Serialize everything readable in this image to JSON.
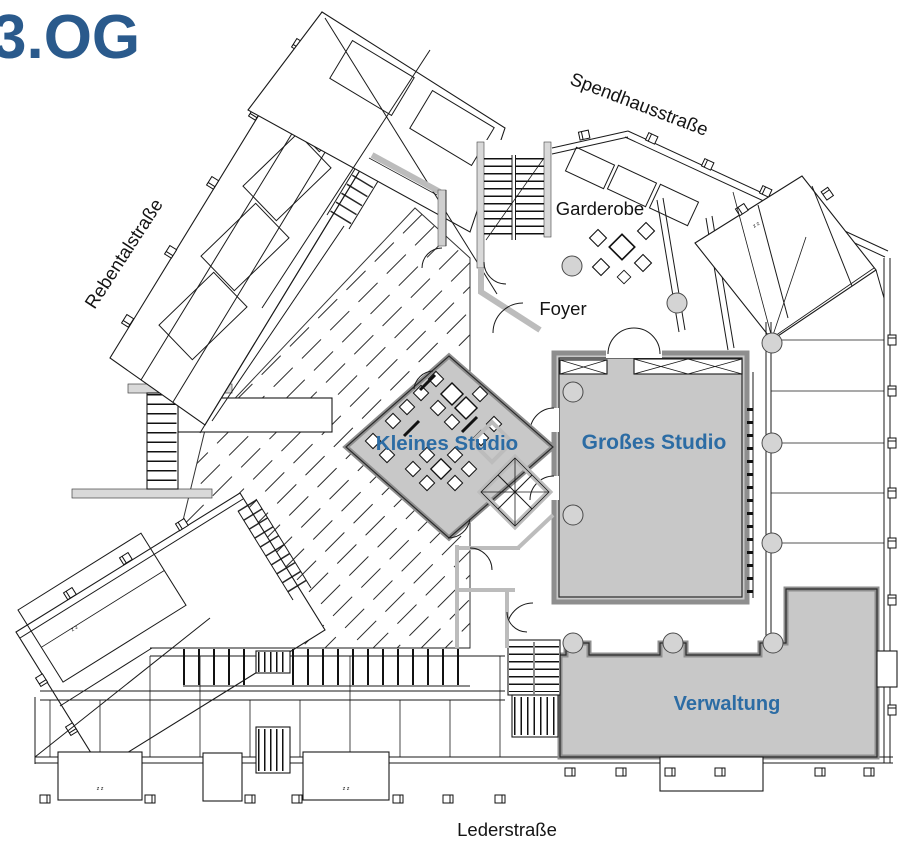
{
  "title": "3.OG",
  "streets": {
    "top": "Spendhausstraße",
    "left": "Rebentalstraße",
    "bottom": "Lederstraße"
  },
  "rooms": {
    "garderobe": "Garderobe",
    "foyer": "Foyer",
    "kleines_studio": "Kleines Studio",
    "grosses_studio": "Großes Studio",
    "verwaltung": "Verwaltung"
  },
  "marks": {
    "zz": "z z"
  },
  "colors": {
    "title_blue": "#2A5A8C",
    "label_blue": "#2C6CA4",
    "room_fill": "#C8C8C8",
    "wall_gray": "#C4C4C4",
    "line": "#1A1A1A",
    "column_fill": "#D4D4D4"
  }
}
